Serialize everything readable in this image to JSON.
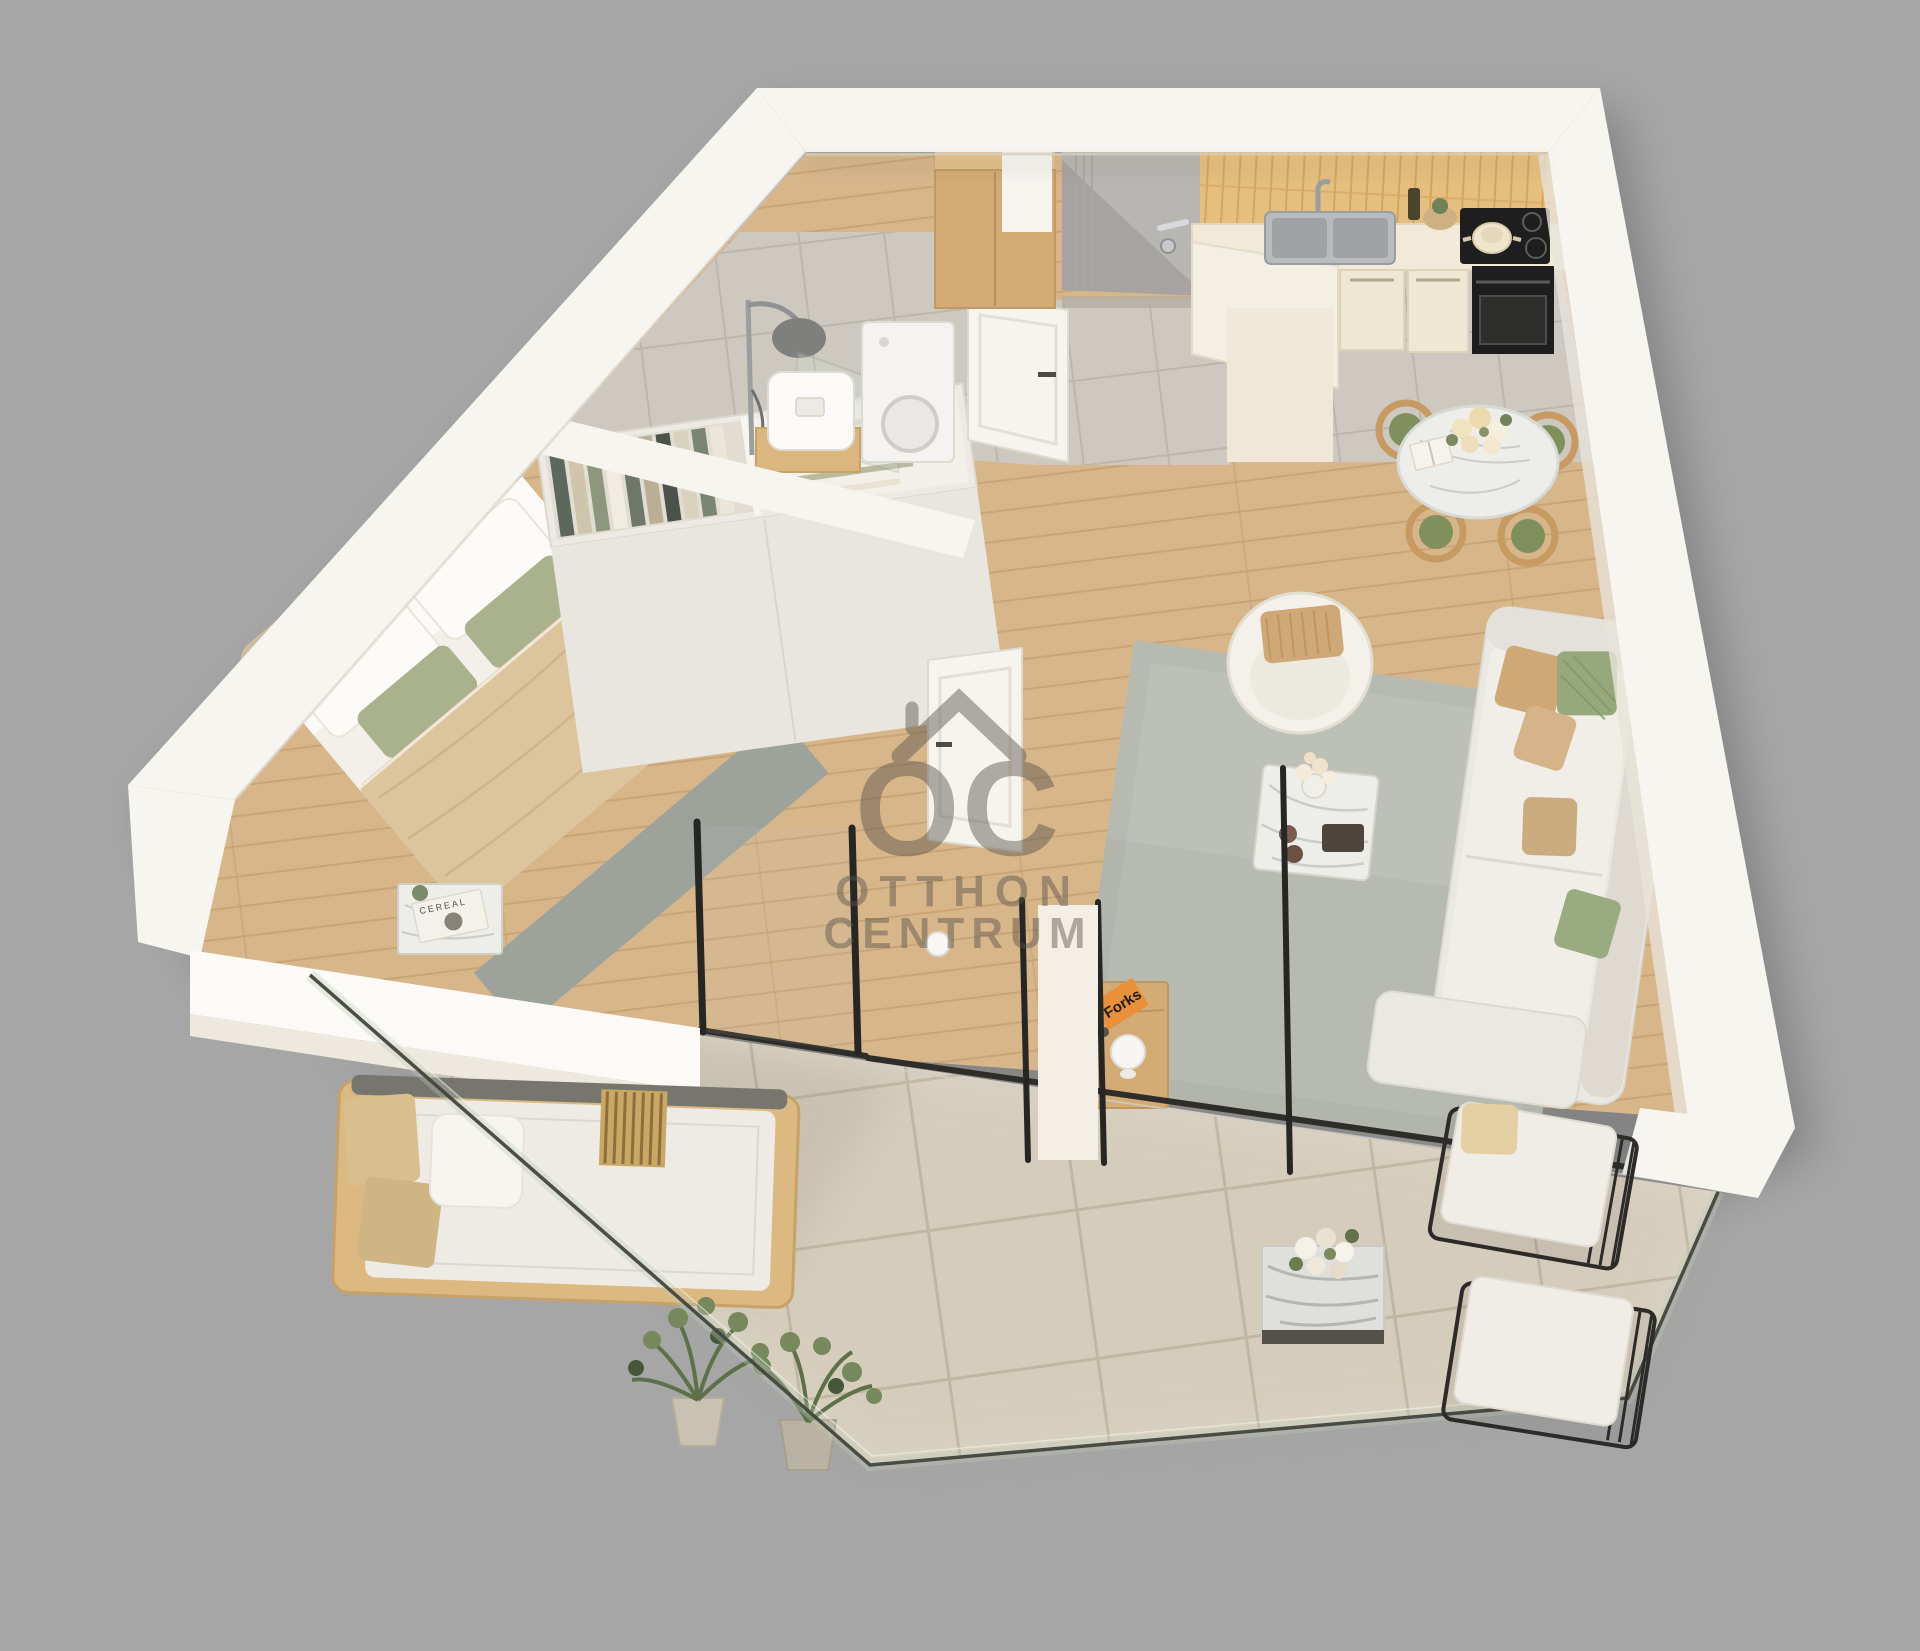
{
  "watermark": {
    "logo_letters": "OC",
    "line1": "OTTHON",
    "line2": "CENTRUM"
  },
  "books": {
    "orange_book_title": "Forks",
    "nightstand_magazine": "CEREAL"
  },
  "palette": {
    "background": "#a6a6a6",
    "wall": "#f7f5f0",
    "wall_shade": "#e8e3d9",
    "wood_floor": "#d7b68a",
    "wood_plank_line": "#c19b6b",
    "gray_tile": "#cdc9c1",
    "gray_tile_grout": "#bcb7ac",
    "balcony_tile": "#ded6c5",
    "balcony_tile_grout": "#c7bda9",
    "rug": "#b6bab0",
    "runner_rug": "#9aa29c",
    "sofa": "#eae8e2",
    "bed_blanket": "#dcc49d",
    "headboard": "#cbbc9f",
    "sage_pillow": "#a9b28d",
    "tan_pillow": "#cfa877",
    "green_cushion": "#7f905c",
    "kitchen_tile": "#e5bf7d",
    "kitchen_cabinet": "#efe7d4",
    "appliance_black": "#1e1e1e",
    "oak_furniture": "#d4ab74",
    "marble": "#edeeea",
    "chrome": "#9b9ea0",
    "glass_line": "#45443f",
    "door_gray": "#b8b6b2",
    "watermark_gray": "#57524b",
    "book_orange": "#e8903a",
    "plant_green": "#5d7048"
  }
}
